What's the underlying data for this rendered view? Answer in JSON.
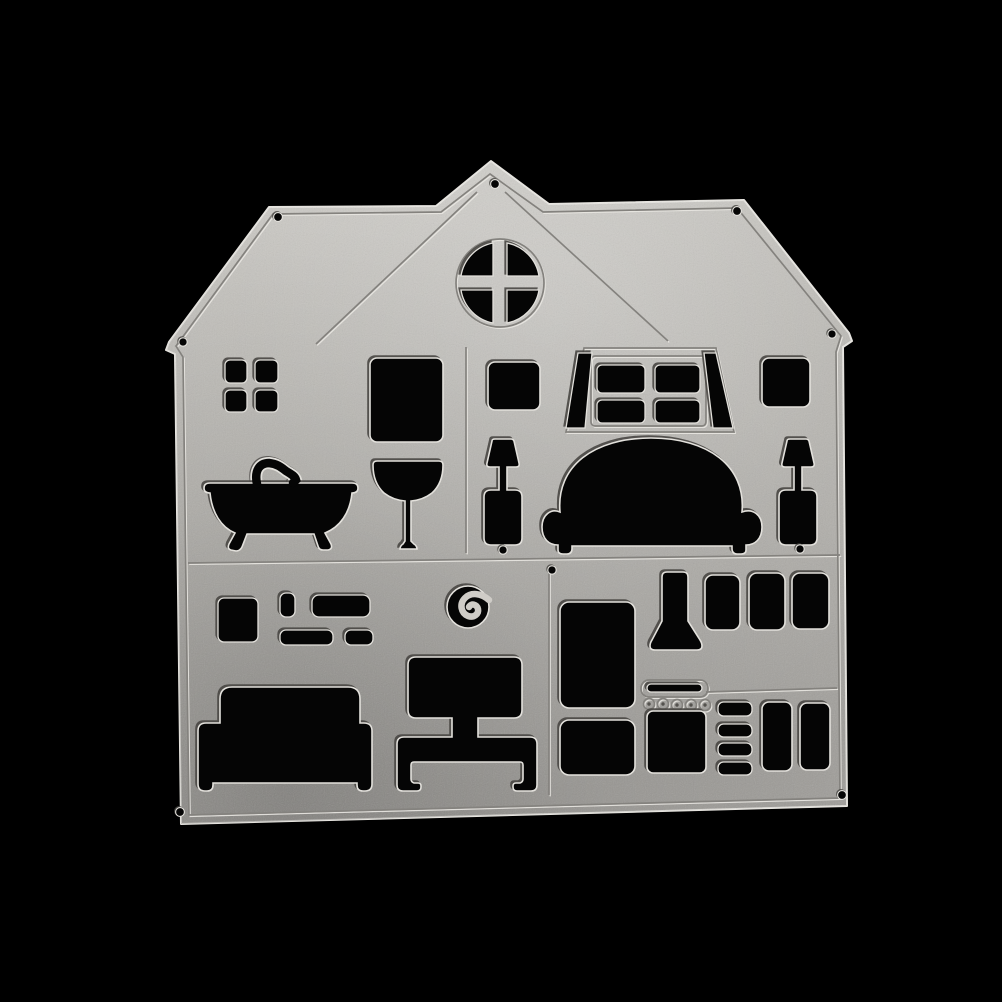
{
  "scene": {
    "kind": "product-photo",
    "subject": "metal-cutting-die",
    "subject_shape": "two-story-house-with-furniture-cutouts",
    "backdrop": "plain-black"
  },
  "colors": {
    "background": "#000000",
    "metal_base": "#b6b4af",
    "metal_light": "#d8d6d1",
    "metal_shadow": "#9b9995",
    "edge_highlight": "#e7e5e0",
    "groove_dark": "#84827e",
    "groove_light": "#e9e7e2",
    "cutout_black": "#050505",
    "cut_rim": "#e3e1dc"
  },
  "die": {
    "attic": [
      "porthole-window-with-cross-muntins"
    ],
    "upper_floor": [
      "four-pane-square-window",
      "mirror-panel",
      "pedestal-basin",
      "clawfoot-bathtub-with-faucet",
      "small-square-window",
      "dormer-window-four-panes-with-side-wedges",
      "sofa",
      "table-lamp-left",
      "table-lamp-right",
      "small-square-window-right"
    ],
    "ground_floor": [
      "picture-frame-square",
      "picture-frame-pill",
      "picture-frame-wide",
      "picture-frame-low-wide",
      "picture-frame-low-small",
      "wall-clock-with-curl",
      "bed-with-headboard",
      "tv-with-stand",
      "fridge-upper-door",
      "fridge-lower-door",
      "extractor-hood-funnel",
      "cupboard-door-1",
      "cupboard-door-2",
      "cupboard-door-3",
      "stove-slit",
      "stove-knobs",
      "oven-door",
      "shelf-slats-x4",
      "tall-cupboard-door-1",
      "tall-cupboard-door-2"
    ],
    "emboss_lines": [
      "border-inset",
      "roof-diagonal-left",
      "roof-diagonal-right",
      "room-divider-vertical-upper",
      "floor-divider-horizontal",
      "room-divider-vertical-lower",
      "countertop-line",
      "dormer-trapezoid",
      "dormer-frame",
      "porthole-ring",
      "stove-pill"
    ],
    "pin_hole_count": 10
  }
}
